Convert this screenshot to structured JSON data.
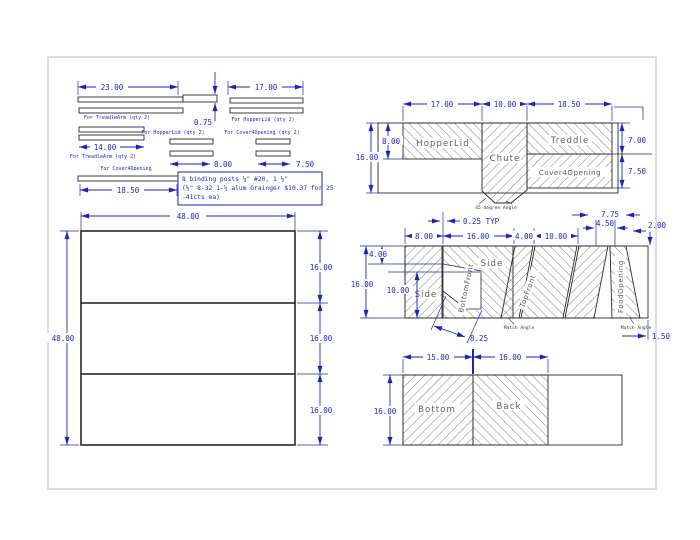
{
  "drawing": {
    "strips": {
      "dim_23": "23.00",
      "dim_17": "17.00",
      "dim_075": "0.75",
      "dim_14": "14.00",
      "dim_8": "8.00",
      "dim_75": "7.50",
      "dim_185": "18.50",
      "label_treadlearm_1": "For TreadleArm (qty 2)",
      "label_hopperlid_1": "For HopperLid (qty 2)",
      "label_hopperlid_2": "For HopperLid (qty 2)",
      "label_cover_2": "For Cover4Opening (qty 2)",
      "label_treadlearm_2": "For TreadleArm (qty 2)",
      "label_cover_1": "For Cover4Opening"
    },
    "note": {
      "line1": "8 binding posts ¼\" #20, 1 ½\"",
      "line2": "(½\" 8-32 1-¼ alum Grainger $10.37 for 25",
      "line3": "-41cts ea)"
    },
    "sheet": {
      "dim_w": "48.00",
      "dim_h": "48.00",
      "dim_row1": "16.00",
      "dim_row2": "16.00",
      "dim_row3": "16.00"
    },
    "panel_top": {
      "dim_17": "17.00",
      "dim_10": "10.00",
      "dim_185": "18.50",
      "dim_8": "8.00",
      "dim_16": "16.00",
      "dim_7": "7.00",
      "dim_75": "7.50",
      "label_hopperlid": "HopperLid",
      "label_chute": "Chute",
      "label_treddle": "Treddle",
      "label_cover": "Cover4Opening",
      "note_angle": "45 degree Angle"
    },
    "panel_mid": {
      "dim_025": "0.25 TYP",
      "dim_8": "8.00",
      "dim_16t": "16.00",
      "dim_4t": "4.00",
      "dim_10t": "10.00",
      "dim_775": "7.75",
      "dim_450": "4.50",
      "dim_200": "2.00",
      "dim_4l": "4.00",
      "dim_16l": "16.00",
      "dim_10l": "10.00",
      "dim_825": "8.25",
      "dim_150": "1.50",
      "label_side1": "Side",
      "label_side2": "Side",
      "label_bottomfront": "BottomFront",
      "label_topfront": "TopFront",
      "label_foodopening": "FoodOpening",
      "note_match1": "Match Angle",
      "note_match2": "Match Angle"
    },
    "panel_bottom": {
      "dim_15": "15.00",
      "dim_16t": "16.00",
      "dim_16l": "16.00",
      "label_bottom": "Bottom",
      "label_back": "Back"
    },
    "colors": {
      "dimension_blue": "#2222bb",
      "outline_black": "#1a1a1a",
      "hatch_gray": "#4a4a4a",
      "label_gray": "#5a5a5a",
      "page_border": "#c9c9c9"
    }
  }
}
